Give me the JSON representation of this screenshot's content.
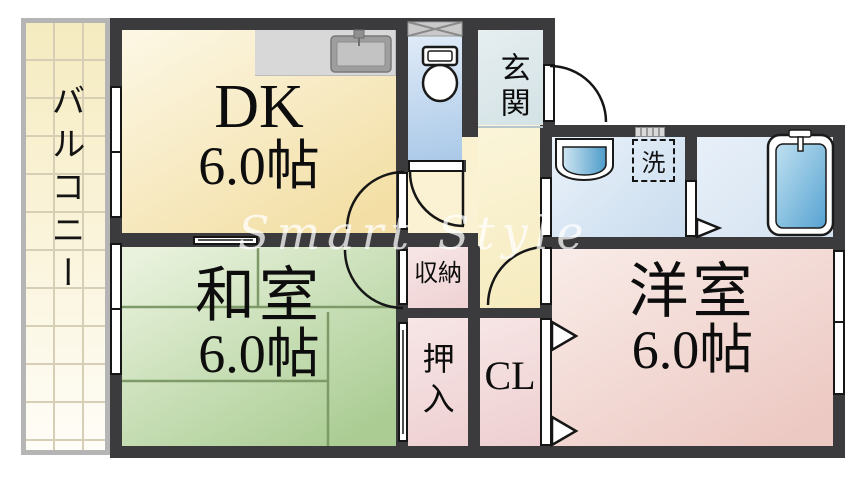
{
  "watermark": "Smart Style",
  "balcony": {
    "label": "バルコニー"
  },
  "rooms": {
    "dk": {
      "name": "DK",
      "size": "6.0帖"
    },
    "washitsu": {
      "name": "和室",
      "size": "6.0帖"
    },
    "youshitsu": {
      "name": "洋室",
      "size": "6.0帖"
    },
    "genkan": {
      "label": "玄関"
    },
    "storage": {
      "label": "収納"
    },
    "oshiire": {
      "label": "押入"
    },
    "closet": {
      "label": "CL"
    },
    "laundry": {
      "label": "洗"
    }
  },
  "colors": {
    "wall": "#3b3b3d",
    "dk_floor": "#f3dfa5",
    "tatami_floor": "#abcd94",
    "tatami_line": "#7d9a68",
    "western_floor": "#edc9c3",
    "closet_floor": "#efd2d4",
    "hall_floor": "#f6ebbe",
    "wet_area": "#c9dcee",
    "watermark": "#ffffff"
  }
}
